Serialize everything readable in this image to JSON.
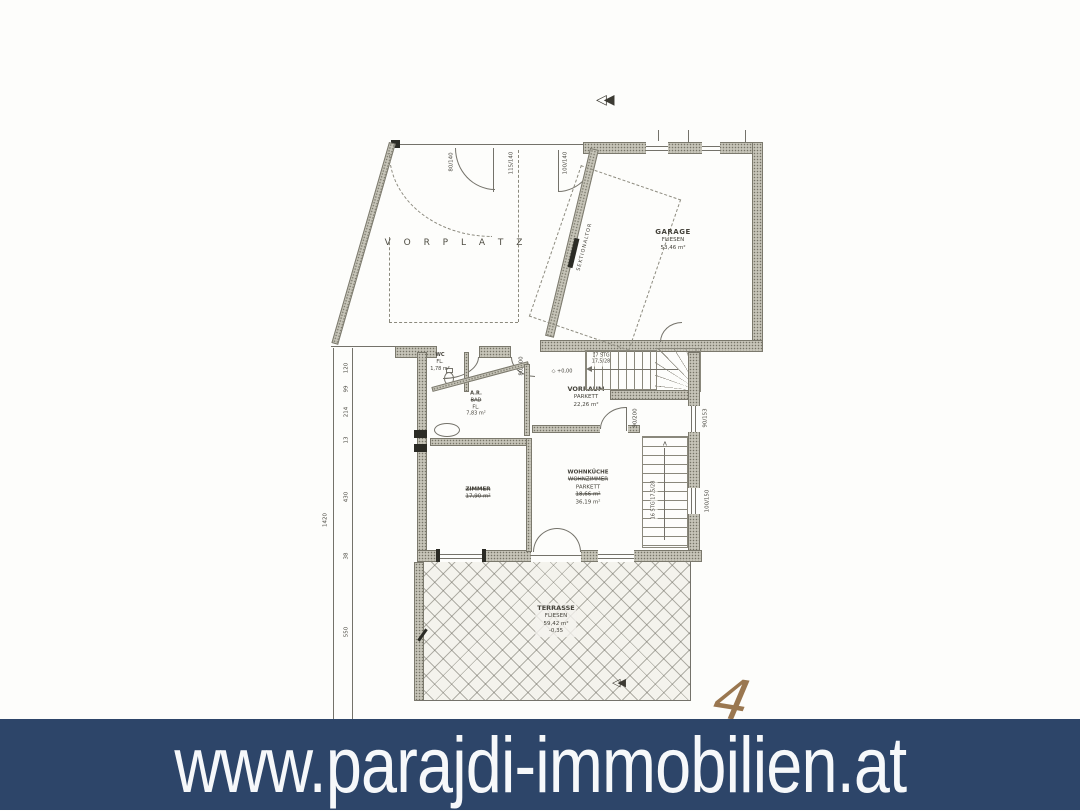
{
  "banner": {
    "url": "www.parajdi-immobilien.at",
    "bg_color": "#2d4569",
    "text_color": "#f6f8fa"
  },
  "plan": {
    "rooms": {
      "vorplatz": {
        "label": "V O R P L A T Z"
      },
      "garage": {
        "line1": "GARAGE",
        "line2": "FLIESEN",
        "line3": "53,46 m²"
      },
      "wc": {
        "line1": "WC",
        "line2": "FL.",
        "line3": "1,78 m²"
      },
      "abstellraum": {
        "line1": "A.R.",
        "line2_struck": "BAD",
        "line3": "FL.",
        "line4": "7,83 m²"
      },
      "vorraum": {
        "line1": "VORRAUM",
        "line2": "PARKETT",
        "line3": "22,26 m²"
      },
      "zimmer": {
        "line1_struck": "ZIMMER",
        "line2_struck": "17,90 m²"
      },
      "wohnkueche": {
        "line1": "WOHNKÜCHE",
        "line2_struck": "WOHNZIMMER",
        "line3": "PARKETT",
        "line4_struck": "18,66 m²",
        "line5": "36,19 m²"
      },
      "terrasse": {
        "line1": "TERRASSE",
        "line2": "FLIESEN",
        "line3": "59,42 m²",
        "line4": "-0,35"
      }
    },
    "labels": {
      "sektionaltor": "SEKTIONALTOR",
      "level_zero": "+0,00",
      "stairs_main_1": "17 STG",
      "stairs_main_2": "17,5/28",
      "stairs_side": "16 STG 17,5/28"
    },
    "dims": {
      "left": [
        "120",
        "99",
        "214",
        "13",
        "430",
        "38",
        "550"
      ],
      "left_total": "1420",
      "top": [
        "80/140",
        "115/140",
        "100/140"
      ],
      "mid": [
        "80/200",
        "90/200"
      ],
      "right": [
        "90/153",
        "100/150"
      ]
    },
    "annotations": {
      "handwritten": "4"
    }
  }
}
